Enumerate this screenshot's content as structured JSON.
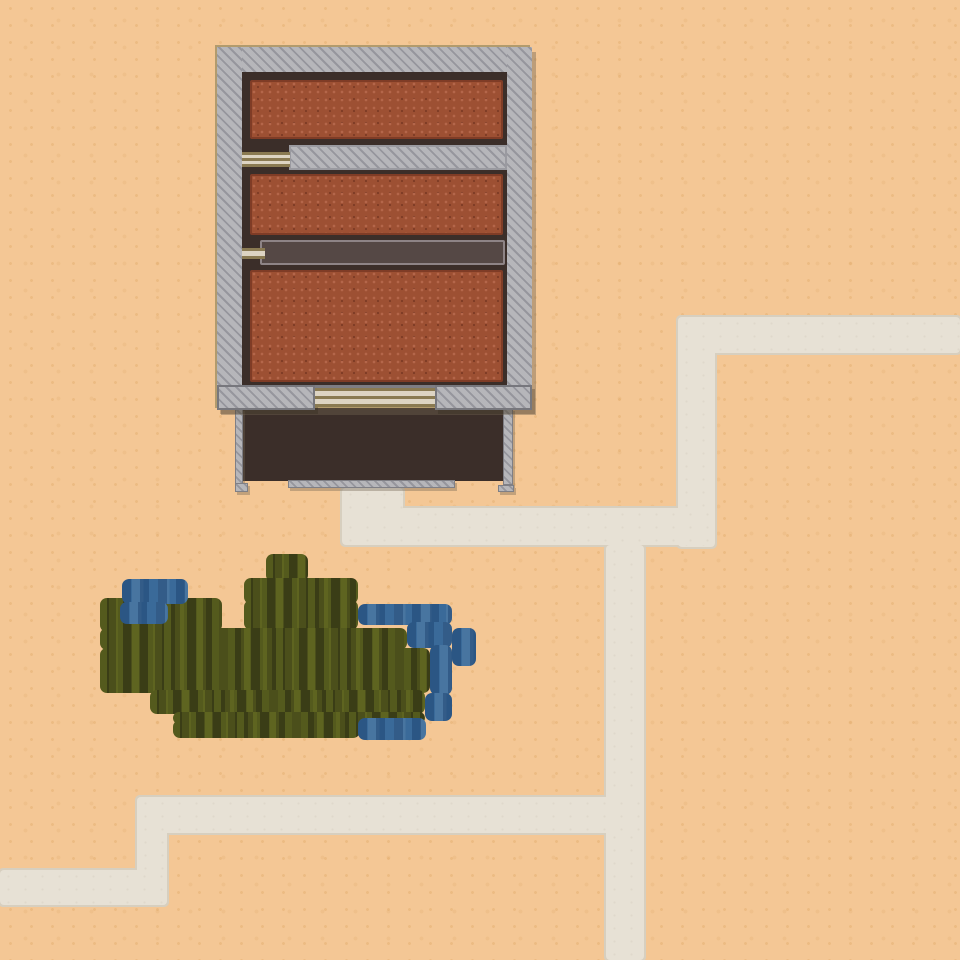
{
  "scene": {
    "description": "top-down desert settlement map with brick building, courtyard, footpaths, marsh vegetation and water pools",
    "canvas": {
      "width": 960,
      "height": 960
    },
    "palette": {
      "sand": "#f4c795",
      "path": "#e7e1d5",
      "pathEdge": "#d7cfbf",
      "wall": "#b6b6ba",
      "wallLine": "rgba(82,82,96,0.32)",
      "wallEdge": "#7d7d83",
      "outlineTan": "#b29b6d",
      "trim": "#3b2e29",
      "brick": "#9d5033",
      "brickLight": "#b4664a",
      "brickDark": "#7f3c26",
      "table": "#554845",
      "tableEdge": "#8e8486",
      "door": "#ddd4c3",
      "doorLine": "#8a7a52",
      "green": "#3a3d16",
      "greenDash": "rgba(120,130,38,0.42)",
      "water": "#3a6a99",
      "waterDash": "rgba(20,55,100,0.40)"
    },
    "paths": [
      {
        "name": "footpath-top-right-horizontal",
        "x": 678,
        "y": 317,
        "w": 282,
        "h": 36
      },
      {
        "name": "footpath-right-vertical",
        "x": 678,
        "y": 317,
        "w": 37,
        "h": 230
      },
      {
        "name": "footpath-middle-horizontal",
        "x": 342,
        "y": 508,
        "w": 373,
        "h": 37
      },
      {
        "name": "footpath-courtyard-stub",
        "x": 342,
        "y": 488,
        "w": 61,
        "h": 30
      },
      {
        "name": "footpath-center-vertical",
        "x": 606,
        "y": 545,
        "w": 38,
        "h": 415
      },
      {
        "name": "footpath-lower-horizontal",
        "x": 137,
        "y": 797,
        "w": 507,
        "h": 36
      },
      {
        "name": "footpath-lower-vertical",
        "x": 137,
        "y": 797,
        "w": 30,
        "h": 108
      },
      {
        "name": "footpath-left-edge-horizontal",
        "x": 0,
        "y": 870,
        "w": 167,
        "h": 35
      }
    ],
    "vegetation": [
      {
        "name": "vegetation-top-bump",
        "x": 266,
        "y": 554,
        "w": 42,
        "h": 28
      },
      {
        "name": "vegetation-upper-block",
        "x": 244,
        "y": 578,
        "w": 114,
        "h": 26
      },
      {
        "name": "vegetation-left-block",
        "x": 100,
        "y": 598,
        "w": 122,
        "h": 34
      },
      {
        "name": "vegetation-mid-block",
        "x": 244,
        "y": 600,
        "w": 114,
        "h": 30
      },
      {
        "name": "vegetation-band-1",
        "x": 100,
        "y": 628,
        "w": 307,
        "h": 22
      },
      {
        "name": "vegetation-band-2",
        "x": 100,
        "y": 648,
        "w": 330,
        "h": 45
      },
      {
        "name": "vegetation-band-3",
        "x": 150,
        "y": 690,
        "w": 275,
        "h": 24
      },
      {
        "name": "vegetation-band-4",
        "x": 173,
        "y": 712,
        "w": 252,
        "h": 12
      },
      {
        "name": "vegetation-bottom-band",
        "x": 173,
        "y": 720,
        "w": 187,
        "h": 18
      }
    ],
    "water": [
      {
        "name": "water-pool-northwest-upper",
        "x": 122,
        "y": 579,
        "w": 66,
        "h": 25
      },
      {
        "name": "water-pool-northwest-lower",
        "x": 120,
        "y": 602,
        "w": 48,
        "h": 22
      },
      {
        "name": "water-pool-east-top",
        "x": 358,
        "y": 604,
        "w": 94,
        "h": 21
      },
      {
        "name": "water-pool-east-mid",
        "x": 407,
        "y": 622,
        "w": 45,
        "h": 26
      },
      {
        "name": "water-pool-east-column",
        "x": 430,
        "y": 645,
        "w": 22,
        "h": 50
      },
      {
        "name": "water-pool-east-bump",
        "x": 452,
        "y": 628,
        "w": 24,
        "h": 38
      },
      {
        "name": "water-pool-southeast",
        "x": 425,
        "y": 693,
        "w": 27,
        "h": 28
      },
      {
        "name": "water-pool-south-band",
        "x": 358,
        "y": 718,
        "w": 68,
        "h": 22
      }
    ],
    "building": {
      "shell": {
        "name": "building-shell",
        "x": 215,
        "y": 45,
        "w": 315,
        "h": 363
      },
      "inner_frame": {
        "name": "wall-inner-edge",
        "x": 21,
        "y": 21,
        "w": 273,
        "h": 321
      },
      "walls": [
        {
          "name": "wall-top",
          "x": 0,
          "y": 0,
          "w": 315,
          "h": 25,
          "style": "hatch"
        },
        {
          "name": "wall-left",
          "x": 0,
          "y": 0,
          "w": 25,
          "h": 363,
          "style": "hatch"
        },
        {
          "name": "wall-right",
          "x": 290,
          "y": 0,
          "w": 25,
          "h": 363,
          "style": "hatch"
        },
        {
          "name": "wall-bottom-left",
          "x": 0,
          "y": 338,
          "w": 98,
          "h": 25,
          "style": "hatch bwall"
        },
        {
          "name": "wall-bottom-right",
          "x": 218,
          "y": 338,
          "w": 97,
          "h": 25,
          "style": "hatch bwall"
        },
        {
          "name": "room-divider-wall",
          "x": 72,
          "y": 98,
          "w": 218,
          "h": 25,
          "style": "hatch divider"
        }
      ],
      "rooms": [
        {
          "name": "brick-room-north",
          "x": 33,
          "y": 33,
          "w": 253,
          "h": 59
        },
        {
          "name": "brick-room-middle",
          "x": 33,
          "y": 127,
          "w": 253,
          "h": 61
        },
        {
          "name": "brick-room-south",
          "x": 33,
          "y": 223,
          "w": 253,
          "h": 112
        }
      ],
      "table": {
        "name": "long-table",
        "x": 43,
        "y": 193,
        "w": 245,
        "h": 25
      },
      "doors": [
        {
          "name": "door-west-upper",
          "x": 25,
          "y": 105,
          "w": 48,
          "h": 15,
          "small": false
        },
        {
          "name": "door-west-lower",
          "x": 25,
          "y": 201,
          "w": 23,
          "h": 11,
          "small": true
        },
        {
          "name": "door-south-gate",
          "x": 98,
          "y": 341,
          "w": 120,
          "h": 19,
          "small": false
        }
      ]
    },
    "courtyard": {
      "floor": {
        "name": "courtyard-floor",
        "x": 243,
        "y": 405,
        "w": 260,
        "h": 76
      },
      "walls": [
        {
          "name": "courtyard-wall-west",
          "x": 235,
          "y": 408,
          "w": 8,
          "h": 77
        },
        {
          "name": "courtyard-wall-west-foot",
          "x": 235,
          "y": 483,
          "w": 13,
          "h": 9
        },
        {
          "name": "courtyard-wall-south",
          "x": 288,
          "y": 480,
          "w": 167,
          "h": 8
        },
        {
          "name": "courtyard-wall-east",
          "x": 503,
          "y": 408,
          "w": 10,
          "h": 77
        },
        {
          "name": "courtyard-wall-east-foot",
          "x": 498,
          "y": 485,
          "w": 16,
          "h": 7
        }
      ]
    }
  }
}
